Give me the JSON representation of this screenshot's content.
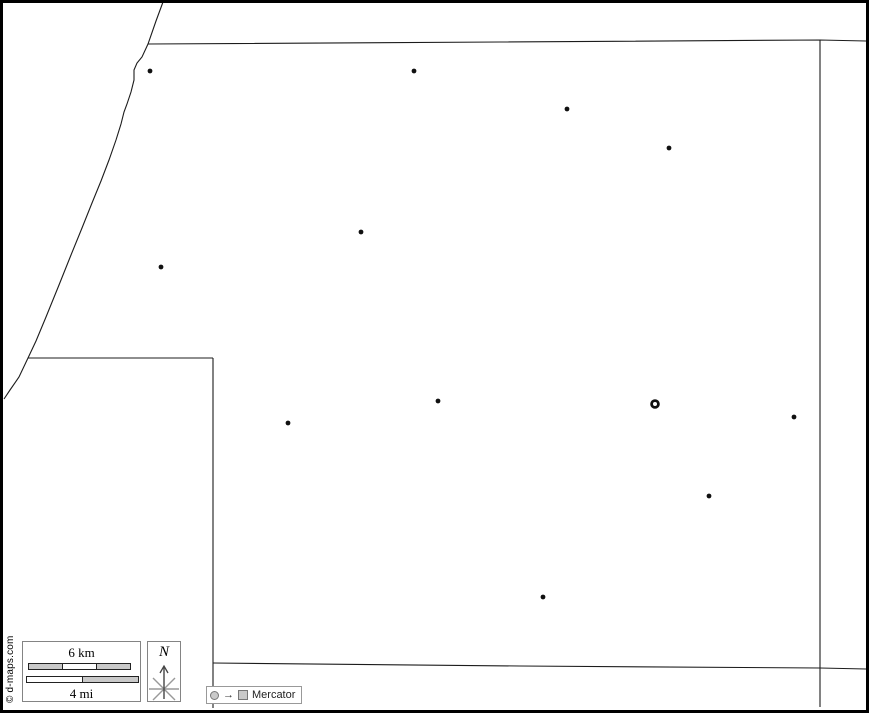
{
  "map": {
    "canvas": {
      "width": 869,
      "height": 713,
      "background": "#ffffff",
      "frame_color": "#000000",
      "boundary_color": "#1c1c1c"
    },
    "boundaries": [
      {
        "name": "northwest-diagonal-boundary",
        "points": [
          [
            163,
            2
          ],
          [
            156,
            21
          ],
          [
            148,
            44
          ],
          [
            142,
            57
          ],
          [
            137,
            63
          ],
          [
            134,
            70
          ],
          [
            134,
            80
          ],
          [
            131,
            92
          ],
          [
            127,
            104
          ],
          [
            124,
            112
          ],
          [
            121,
            124
          ],
          [
            116,
            140
          ],
          [
            109,
            160
          ],
          [
            101,
            181
          ],
          [
            92,
            203
          ],
          [
            82,
            228
          ],
          [
            71,
            255
          ],
          [
            59,
            285
          ],
          [
            46,
            317
          ],
          [
            36,
            341
          ],
          [
            28,
            358
          ],
          [
            19,
            377
          ],
          [
            10,
            390
          ],
          [
            4,
            399
          ]
        ]
      },
      {
        "name": "north-boundary",
        "points": [
          [
            148,
            44
          ],
          [
            500,
            42
          ],
          [
            820,
            40
          ],
          [
            866,
            41
          ]
        ]
      },
      {
        "name": "east-boundary",
        "points": [
          [
            820,
            40
          ],
          [
            820,
            667
          ],
          [
            820,
            707
          ]
        ]
      },
      {
        "name": "south-boundary",
        "points": [
          [
            213,
            663
          ],
          [
            520,
            666
          ],
          [
            820,
            668
          ],
          [
            866,
            669
          ]
        ]
      },
      {
        "name": "west-lower-boundary",
        "points": [
          [
            213,
            358
          ],
          [
            213,
            708
          ]
        ]
      },
      {
        "name": "notch-boundary",
        "points": [
          [
            28,
            358
          ],
          [
            213,
            358
          ]
        ]
      }
    ],
    "towns": {
      "dot_color": "#111111",
      "radius": 2.4,
      "points": [
        [
          150,
          71
        ],
        [
          414,
          71
        ],
        [
          567,
          109
        ],
        [
          669,
          148
        ],
        [
          361,
          232
        ],
        [
          161,
          267
        ],
        [
          438,
          401
        ],
        [
          288,
          423
        ],
        [
          794,
          417
        ],
        [
          709,
          496
        ],
        [
          543,
          597
        ]
      ]
    },
    "county_seat": {
      "x": 655,
      "y": 404,
      "ring_radius": 3.4,
      "ring_width": 2.8,
      "color": "#111111"
    }
  },
  "legend": {
    "copyright": "© d-maps.com",
    "scale_box": {
      "km_label": "6 km",
      "mi_label": "4 mi",
      "segment_fill": "#c9c9c9",
      "segment_empty": "#ffffff"
    },
    "compass": {
      "label": "N"
    },
    "projection": {
      "label": "Mercator",
      "icon_fill": "#c9c9c9"
    }
  }
}
